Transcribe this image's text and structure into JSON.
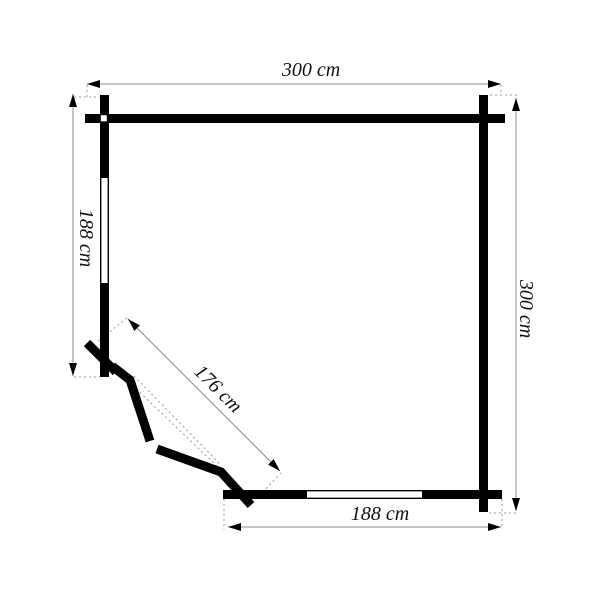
{
  "diagram": {
    "type": "floor-plan",
    "dimensions": {
      "top_width": "300 cm",
      "right_depth": "300 cm",
      "left_front_height": "188 cm",
      "bottom_front_width": "188 cm",
      "diagonal_door_wall": "176 cm"
    }
  },
  "colors": {
    "background": "#ffffff",
    "wall": "#000000",
    "dimension_line": "#888888",
    "extension_line": "#999999",
    "label_text": "#111111"
  }
}
